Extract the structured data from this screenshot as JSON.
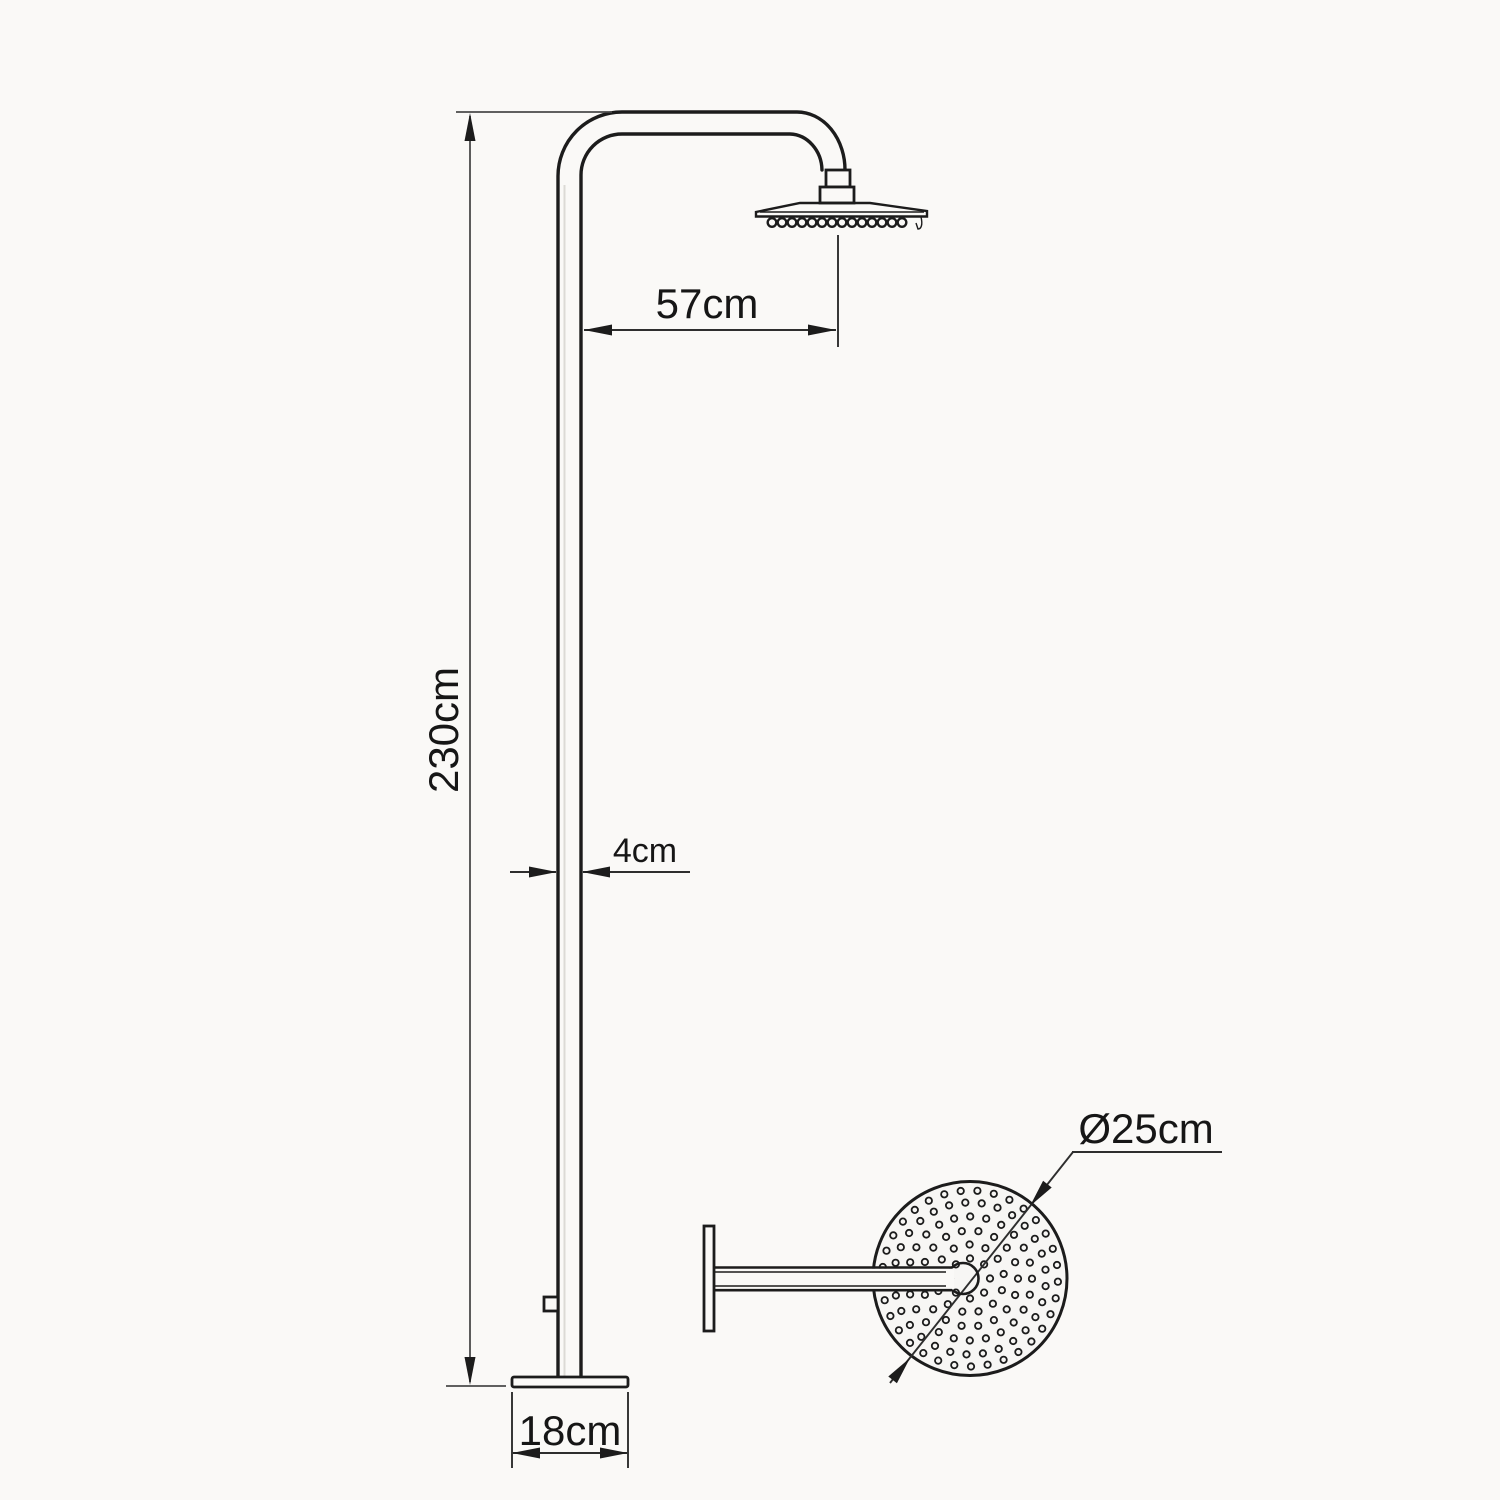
{
  "page": {
    "background_color": "#faf9f7",
    "line_color": "#1c1c1c"
  },
  "dimensions": {
    "arm_reach_label": "57cm",
    "column_height_label": "230cm",
    "pipe_width_label": "4cm",
    "base_width_label": "18cm",
    "head_diameter_label": "Ø25cm"
  }
}
